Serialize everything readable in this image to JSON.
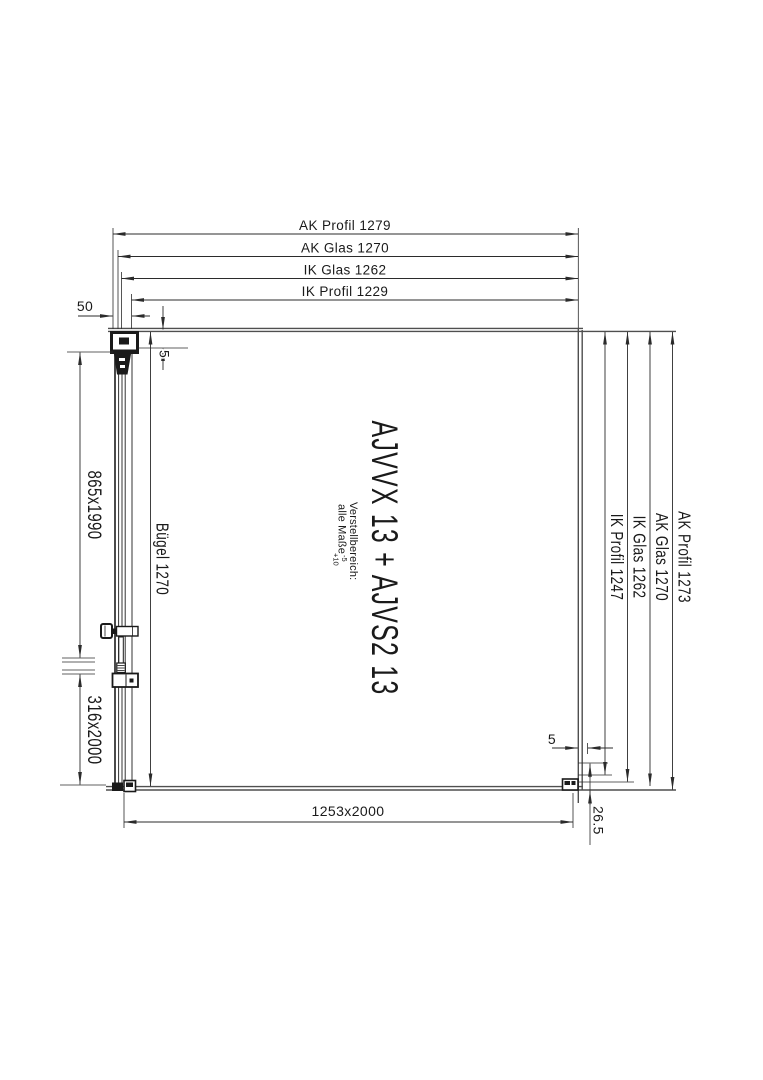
{
  "drawing": {
    "title": "AJVVX 13 + AJVS2 13",
    "note": {
      "line1": "Verstellbereich:",
      "line2": "alle Maße",
      "tol_minus": "-5",
      "tol_plus": "+10"
    },
    "dims": {
      "top": [
        "AK Profil 1279",
        "AK Glas 1270",
        "IK Glas 1262",
        "IK Profil 1229"
      ],
      "right": [
        "IK Profil 1247",
        "IK Glas 1262",
        "AK Glas 1270",
        "AK Profil 1273"
      ],
      "left_upper": "865x1990",
      "left_lower": "316x2000",
      "buegel": "Bügel 1270",
      "bottom": "1253x2000",
      "wall_offset": "50",
      "gap_top": "5",
      "gap_bottom_right": "5",
      "bottom_rail": "26.5"
    },
    "colors": {
      "line": "#2b2b2b",
      "edge": "#4f4f4f",
      "text": "#1a1a1a",
      "background": "#ffffff"
    }
  }
}
